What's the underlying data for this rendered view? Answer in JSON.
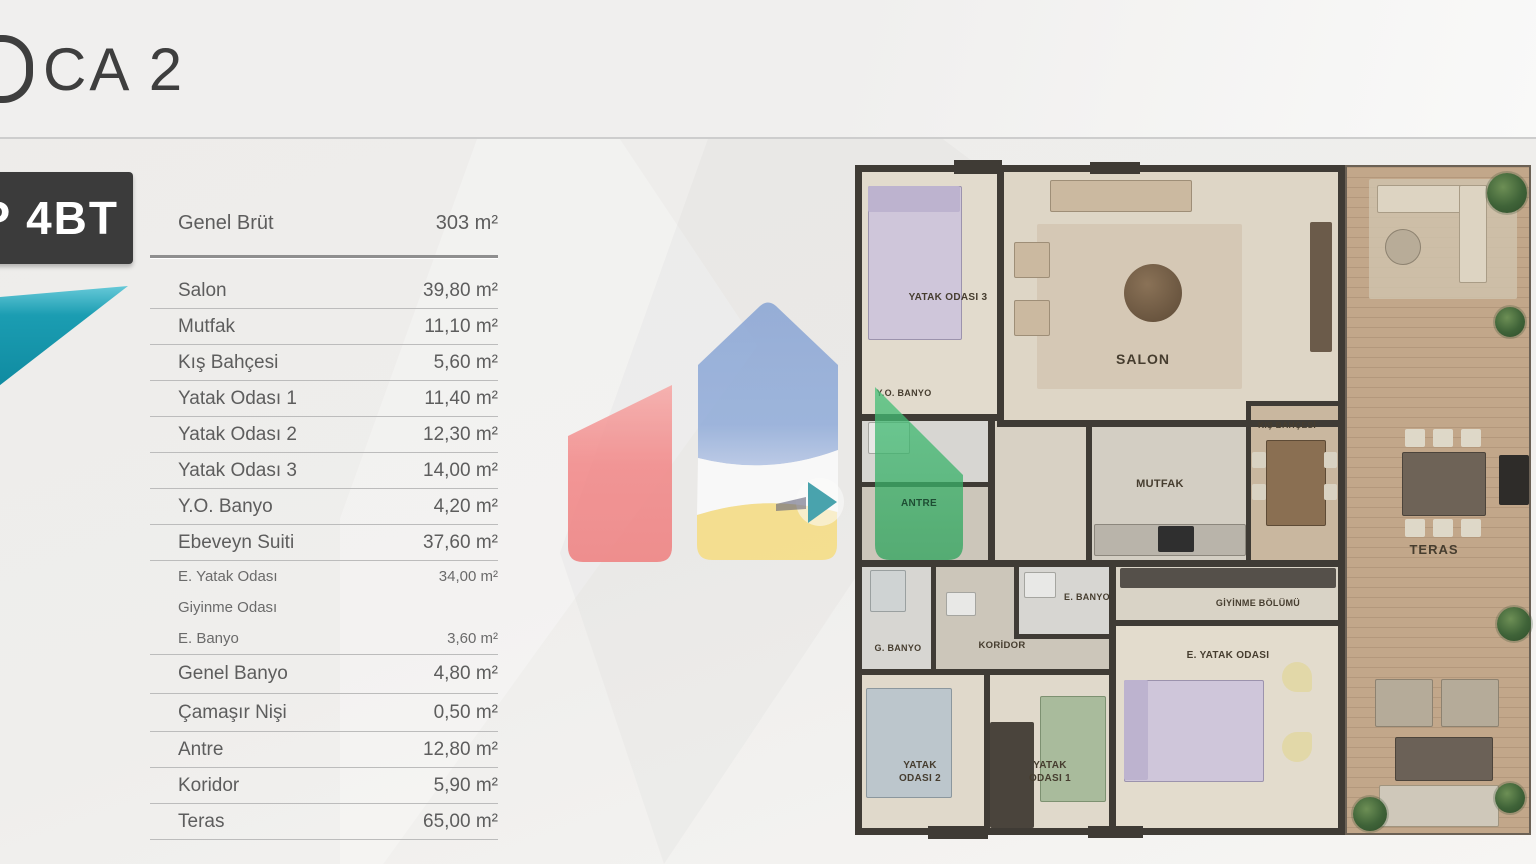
{
  "header": {
    "title_visible": "CA 2"
  },
  "sidebar": {
    "type_badge": "P 4BT",
    "table": {
      "gross": {
        "label": "Genel Brüt",
        "value": "303 m²"
      },
      "rows": [
        {
          "label": "Salon",
          "value": "39,80 m²"
        },
        {
          "label": "Mutfak",
          "value": "11,10 m²"
        },
        {
          "label": "Kış Bahçesi",
          "value": "5,60 m²"
        },
        {
          "label": "Yatak Odası 1",
          "value": "11,40 m²"
        },
        {
          "label": "Yatak Odası 2",
          "value": "12,30 m²"
        },
        {
          "label": "Yatak Odası 3",
          "value": "14,00 m²"
        },
        {
          "label": "Y.O. Banyo",
          "value": "4,20 m²"
        },
        {
          "label": "Ebeveyn Suiti",
          "value": "37,60 m²"
        },
        {
          "label": "E. Yatak Odası",
          "value": "34,00 m²"
        },
        {
          "label": "Giyinme Odası",
          "value": ""
        },
        {
          "label": "E. Banyo",
          "value": "3,60 m²"
        },
        {
          "label": "Genel Banyo",
          "value": "4,80 m²"
        },
        {
          "label": "Çamaşır Nişi",
          "value": "0,50 m²"
        },
        {
          "label": "Antre",
          "value": "12,80 m²"
        },
        {
          "label": "Koridor",
          "value": "5,90 m²"
        },
        {
          "label": "Teras",
          "value": "65,00 m²"
        }
      ]
    }
  },
  "floorplan": {
    "rooms": [
      {
        "label": "YATAK ODASI 3"
      },
      {
        "label": "SALON"
      },
      {
        "label": "Y.O. BANYO"
      },
      {
        "label": "ANTRE"
      },
      {
        "label": "MUTFAK"
      },
      {
        "label": "KIŞ BAHÇESİ"
      },
      {
        "label": "E. BANYO"
      },
      {
        "label": "GİYİNME BÖLÜMÜ"
      },
      {
        "label": "G. BANYO"
      },
      {
        "label": "KORİDOR"
      },
      {
        "label": "E. YATAK ODASI"
      },
      {
        "label": "YATAK ODASI 2"
      },
      {
        "label": "YATAK ODASI 1"
      },
      {
        "label": "TERAS"
      }
    ]
  },
  "watermark": {
    "colors": {
      "red": "#f28585",
      "blue": "#89a5d6",
      "yellow": "#f6dd80",
      "green": "#3cb96d",
      "teal_arrow": "#2b96a3",
      "brand_teal": "#169cb1"
    }
  }
}
